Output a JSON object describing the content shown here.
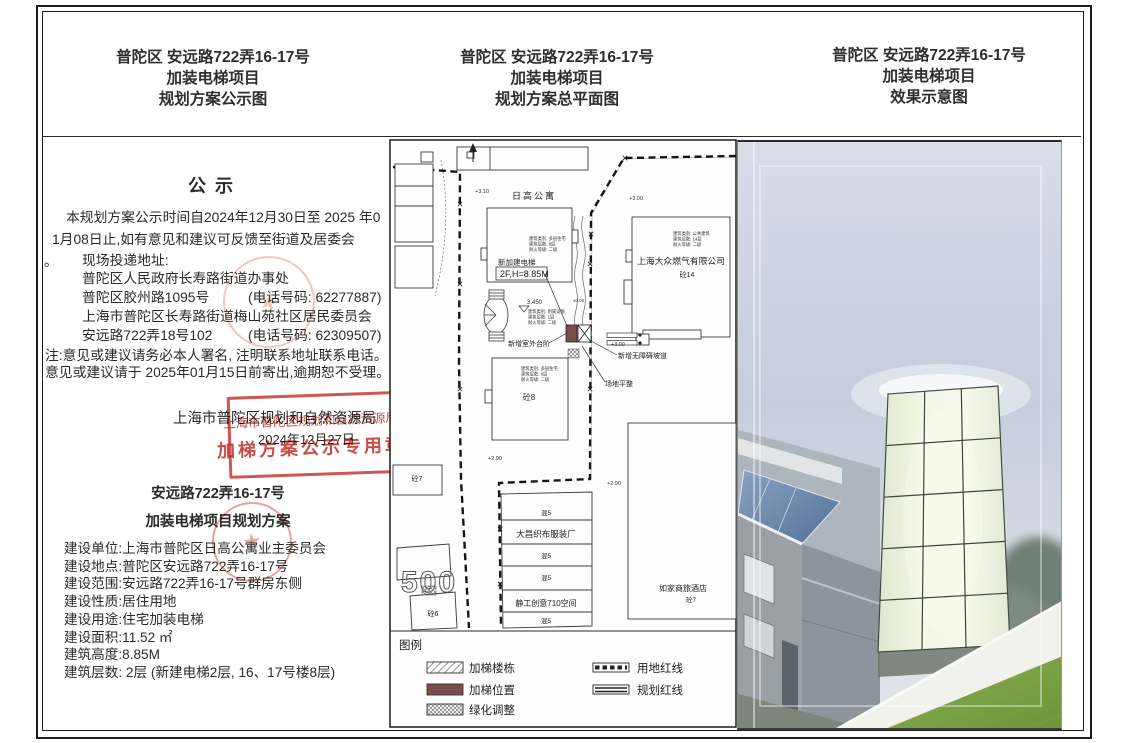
{
  "sheet": {
    "headers": [
      {
        "address": "普陀区 安远路722弄16-17号",
        "project": "加装电梯项目",
        "sheet": "规划方案公示图"
      },
      {
        "address": "普陀区 安远路722弄16-17号",
        "project": "加装电梯项目",
        "sheet": "规划方案总平面图"
      },
      {
        "address": "普陀区 安远路722弄16-17号",
        "project": "加装电梯项目",
        "sheet": "效果示意图"
      }
    ]
  },
  "notice": {
    "title": "公示",
    "para_line1": "本规划方案公示时间自2024年12月30日至 2025 年0",
    "para_line2": "1月08日止,如有意见和建议可反馈至街道及居委会",
    "para_period": "。",
    "delivery_heading": "现场投递地址:",
    "office1_name": "普陀区人民政府长寿路街道办事处",
    "office1_addr": "普陀区胶州路1095号",
    "office1_phone": "(电话号码: 62277887)",
    "office2_name": "上海市普陀区长寿路街道梅山苑社区居民委员会",
    "office2_addr": "安远路722弄18号102",
    "office2_phone": "(电话号码: 62309507)",
    "note_line1": "注:意见或建议请务必本人署名, 注明联系地址联系电话。",
    "note_line2": "意见或建议请于 2025年01月15日前寄出,逾期恕不受理。",
    "authority": "上海市普陀区规划和自然资源局",
    "publish_date": "2024年12月27日",
    "stamp": {
      "line1": "上海市普陀区规划和自然资源局",
      "line2": "加梯方案公示专用章"
    },
    "seal_star": "★",
    "project_title_line1": "安远路722弄16-17号",
    "project_title_line2": "加装电梯项目规划方案",
    "details": [
      "建设单位:上海市普陀区日高公寓业主委员会",
      "建设地点:普陀区安远路722弄16-17号",
      "建设范围:安远路722弄16-17号群房东侧",
      "建设性质:居住用地",
      "建设用途:住宅加装电梯",
      "建设面积:11.52 ㎡",
      "建筑高度:8.85M",
      "建筑层数: 2层 (新建电梯2层, 16、17号楼8层)"
    ]
  },
  "siteplan": {
    "labels": {
      "apartment": "日高公寓",
      "new_lift": "新加建电梯",
      "lift_spec": "2F,H=8.85M",
      "gas_company": "上海大众燃气有限公司",
      "gas_struct": "砼14",
      "outdoor_steps": "新增室外台阶",
      "ramp": "新增无障碍坡道",
      "grading": "场地平整",
      "t8": "砼8",
      "t7_left": "砼7",
      "t6": "砼6",
      "m5_1": "混5",
      "m5_2": "混5",
      "m5_3": "混5",
      "m5_4": "混5",
      "factory": "大昌织布服装厂",
      "creative": "静工创意710空间",
      "hotel": "如家商旅酒店",
      "hotel_struct": "砼7",
      "num500": "500",
      "e310": "+3.10",
      "e300a": "+3.00",
      "e300b": "+3.00",
      "e290a": "+2.90",
      "e290b": "+2.90",
      "e3450": "3.450",
      "e000": "±0.00"
    },
    "specs": {
      "main": [
        "建筑类别: 多层住宅",
        "建筑层数: 8层",
        "耐火等级: 二级"
      ],
      "annex": [
        "建筑类别: 附属设施",
        "建筑层数: 1层",
        "耐火等级: 二级"
      ],
      "gas": [
        "建筑类别: 公共建筑",
        "建筑层数: 14层",
        "耐火等级: 二级"
      ],
      "t8": [
        "建筑类别: 多层住宅",
        "建筑层数: 8层",
        "耐火等级: 二级"
      ]
    },
    "legend": {
      "title": "图例",
      "items": [
        {
          "label": "加梯楼栋",
          "swatch": "diagonal-hatch"
        },
        {
          "label": "加梯位置",
          "swatch": "solid-maroon"
        },
        {
          "label": "绿化调整",
          "swatch": "cross-hatch"
        },
        {
          "label": "用地红线",
          "swatch": "dashed-line"
        },
        {
          "label": "规划红线",
          "swatch": "double-line"
        }
      ]
    }
  },
  "colors": {
    "stamp_red": "#c23c30",
    "lift_position_maroon": "#7b4d4a",
    "lawn_green": "#7fa544",
    "glass_pale_green": "#eef2dc",
    "canopy_blue": "#6785a8",
    "sky_blue_gray": "#bcc6d8"
  }
}
